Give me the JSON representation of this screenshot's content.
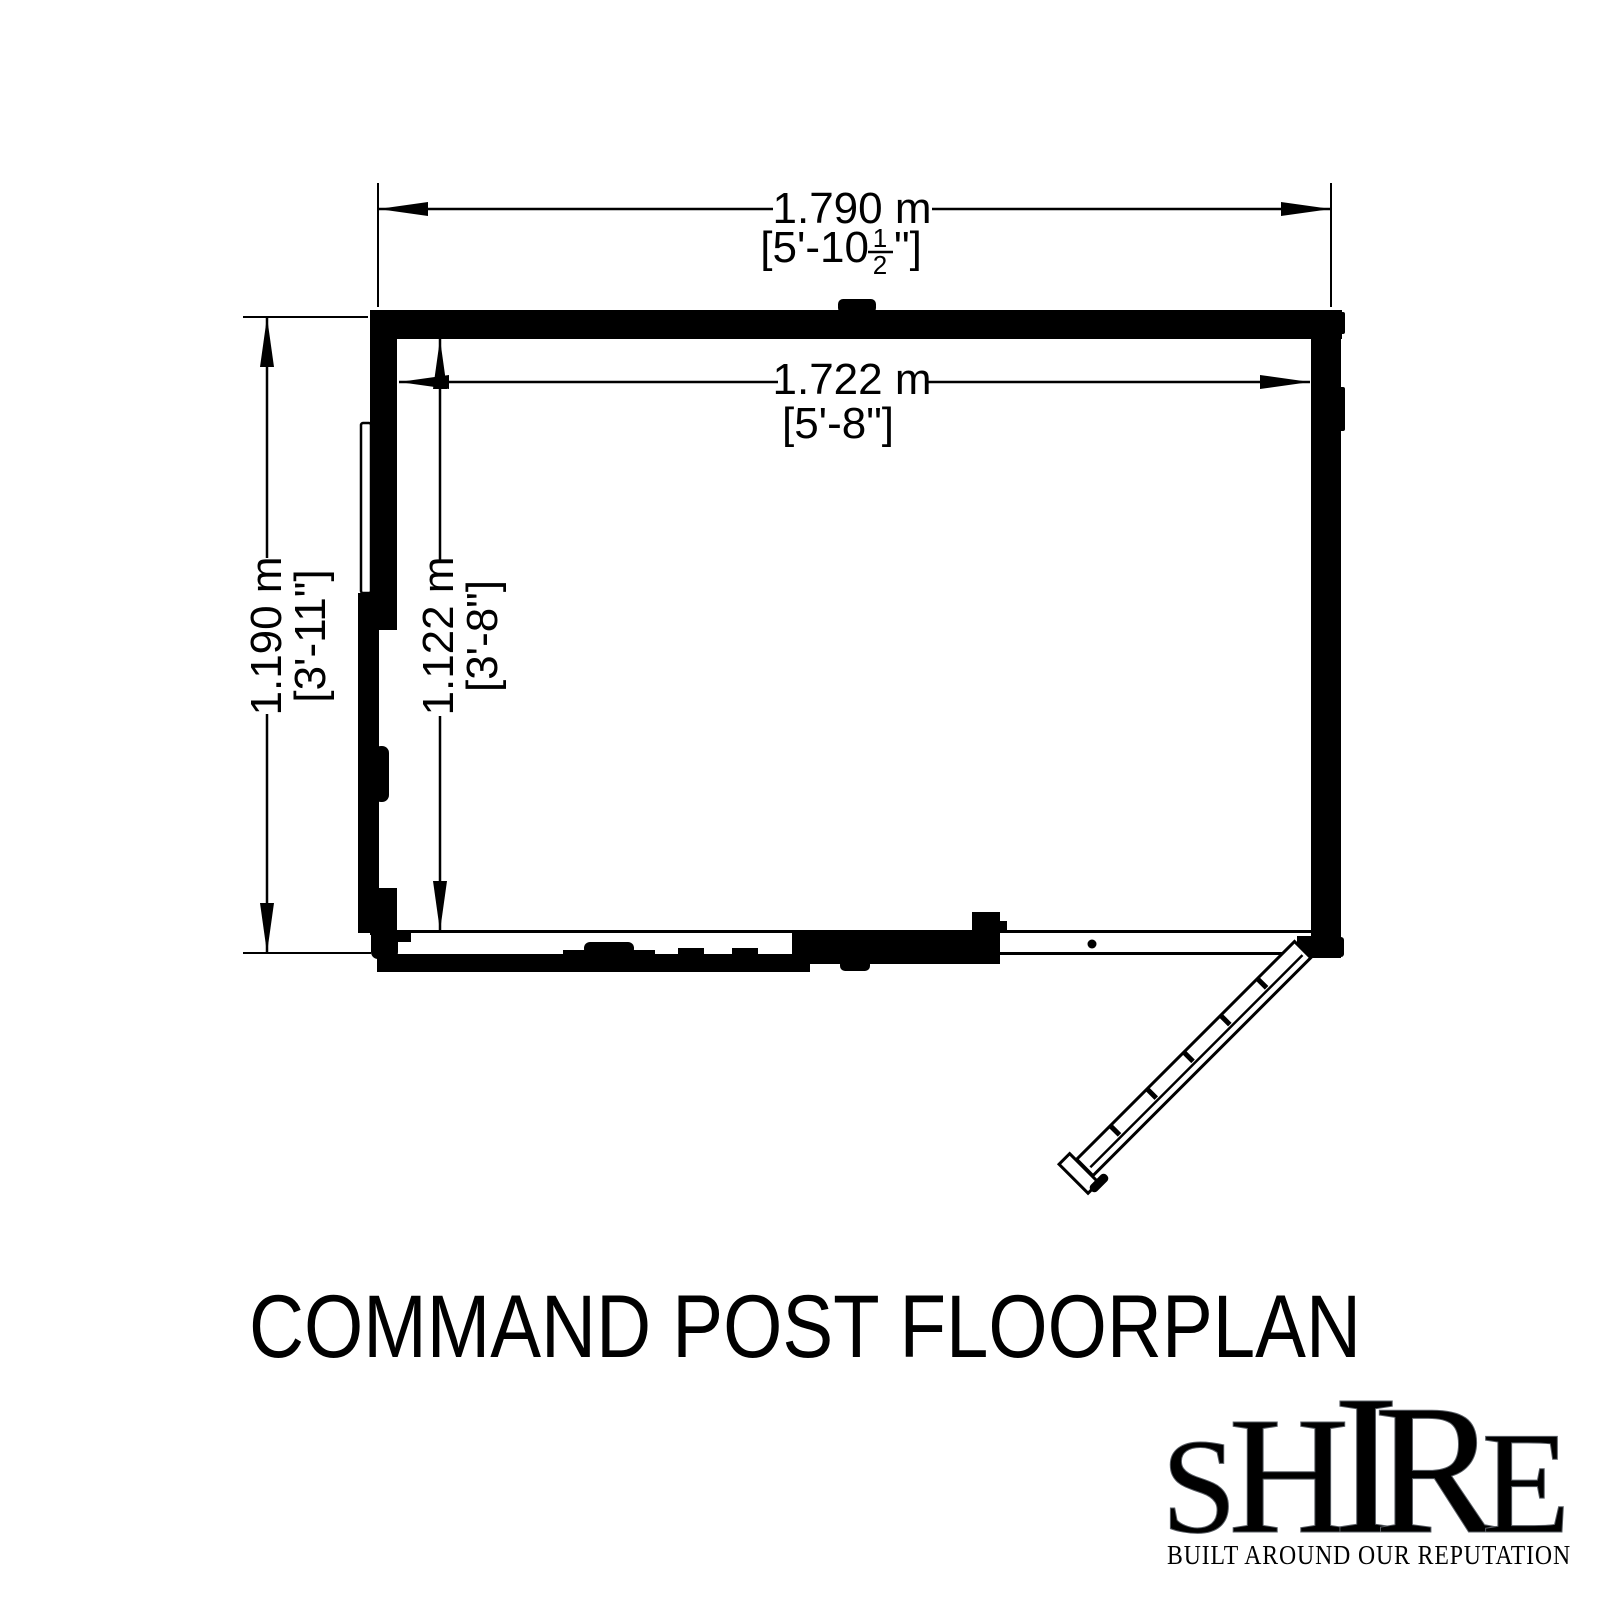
{
  "canvas": {
    "background": "#ffffff",
    "ink": "#000000"
  },
  "title": {
    "text": "COMMAND POST FLOORPLAN"
  },
  "floorplan": {
    "outer_width": {
      "metric": "1.790 m",
      "imperial_prefix": "[5'-10",
      "fraction_numerator": "1",
      "fraction_denominator": "2",
      "imperial_suffix": "\"]"
    },
    "inner_width": {
      "metric": "1.722 m",
      "imperial": "[5'-8\"]"
    },
    "outer_depth": {
      "metric": "1.190 m",
      "imperial": "[3'-11\"]"
    },
    "inner_depth": {
      "metric": "1.122 m",
      "imperial": "[3'-8\"]"
    }
  },
  "logo": {
    "letters": [
      "S",
      "H",
      "I",
      "R",
      "E"
    ],
    "tagline": "BUILT AROUND OUR REPUTATION",
    "flag_blue": "#1E3A7A",
    "flag_red": "#C8102E",
    "flag_white": "#EDF1F6",
    "tagline_navy": "#1F3864",
    "tagline_red": "#7A2230",
    "tagline_gray": "#8D939C"
  }
}
